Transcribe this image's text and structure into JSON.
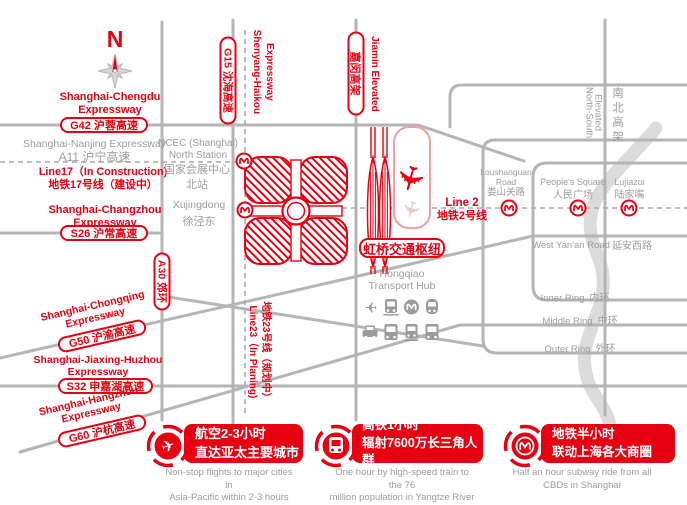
{
  "compass": {
    "n": "N"
  },
  "icons": {
    "plane_glyph": "✈"
  },
  "labels": {
    "chengdu": {
      "l1": "Shanghai-Chengdu",
      "l2": "Expressway",
      "badge": "G42 沪蓉高速"
    },
    "nanjing": {
      "l1": "Shanghai-Nanjing Expressway",
      "l2": "A11 沪宁高速"
    },
    "line17": {
      "l1": "Line17（In Construction)",
      "l2": "地铁17号线（建设中）"
    },
    "changzhou": {
      "l1": "Shanghai-Changzhou",
      "l2": "Expressway",
      "badge": "S26 沪常高速"
    },
    "a30": {
      "badge": "A30 郊环"
    },
    "chongqing": {
      "l1": "Shanghai-Chongqing",
      "l2": "Expressway",
      "badge": "G50 沪渝高速"
    },
    "jiaxinghuzhou": {
      "l1": "Shanghai-Jiaxing-Huzhou",
      "l2": "Expressway",
      "badge": "S32 申嘉湖高速"
    },
    "hangzhou": {
      "l1": "Shanghai-Hangzhou",
      "l2": "Expressway",
      "badge": "G60 沪杭高速"
    },
    "shenyanghaikou": {
      "l1": "Shenyang-Haikou",
      "l2": "Expressway",
      "badge": "G15 沈海高速"
    },
    "jiamin": {
      "en": "Jiamin Elevated",
      "badge": "嘉闵高架"
    },
    "line23": {
      "l1": "Line23（In Planing)",
      "l2": "地铁23号线（规划中）"
    },
    "line2": {
      "l1": "Line 2",
      "l2": "地铁2号线"
    },
    "northsouth": {
      "l1": "North-South",
      "l2": "Elevated",
      "zh": "南北高架"
    },
    "westyanan": {
      "en": "West Yan'an Road",
      "zh": "延安西路"
    },
    "innerring": {
      "en": "Inner Ring",
      "zh": "内环"
    },
    "middlering": {
      "en": "Middle Ring",
      "zh": "中环"
    },
    "outerring": {
      "en": "Outer Ring",
      "zh": "外环"
    }
  },
  "stations": {
    "ncec": {
      "en1": "NCEC (Shanghai)",
      "en2": "North Station",
      "zh1": "国家会展中心",
      "zh2": "北站"
    },
    "xujingdong": {
      "en": "Xujingdong",
      "zh": "徐泾东"
    },
    "loushanguan": {
      "en1": "Loushanguan",
      "en2": "Road",
      "zh": "娄山关路"
    },
    "peoples": {
      "en": "People's Square",
      "zh": "人民广场"
    },
    "lujiazui": {
      "en": "Lujiazui",
      "zh": "陆家嘴"
    }
  },
  "hub": {
    "badge": "虹桥交通枢纽",
    "en1": "Hongqiao",
    "en2": "Transport Hub"
  },
  "legend": [
    {
      "zh1": "航空2-3小时",
      "zh2": "直达亚太主要城市",
      "en1": "Non-stop flights to major cities in",
      "en2": "Asia-Pacific within 2-3 hours"
    },
    {
      "zh1": "高铁1小时",
      "zh2": "辐射7600万长三角人群",
      "en1": "One hour by high-speed train to the 76",
      "en2": "million population in Yangtze River Delta"
    },
    {
      "zh1": "地铁半小时",
      "zh2": "联动上海各大商圈",
      "en1": "Half an hour subway ride from all",
      "en2": "CBDs in Shanghai"
    }
  ],
  "colors": {
    "red": "#e60012",
    "road": "#b5b5b5",
    "gray_text": "#9c9c9c",
    "river": "#dbdbdb",
    "runway_outline": "#f0a0a0"
  }
}
